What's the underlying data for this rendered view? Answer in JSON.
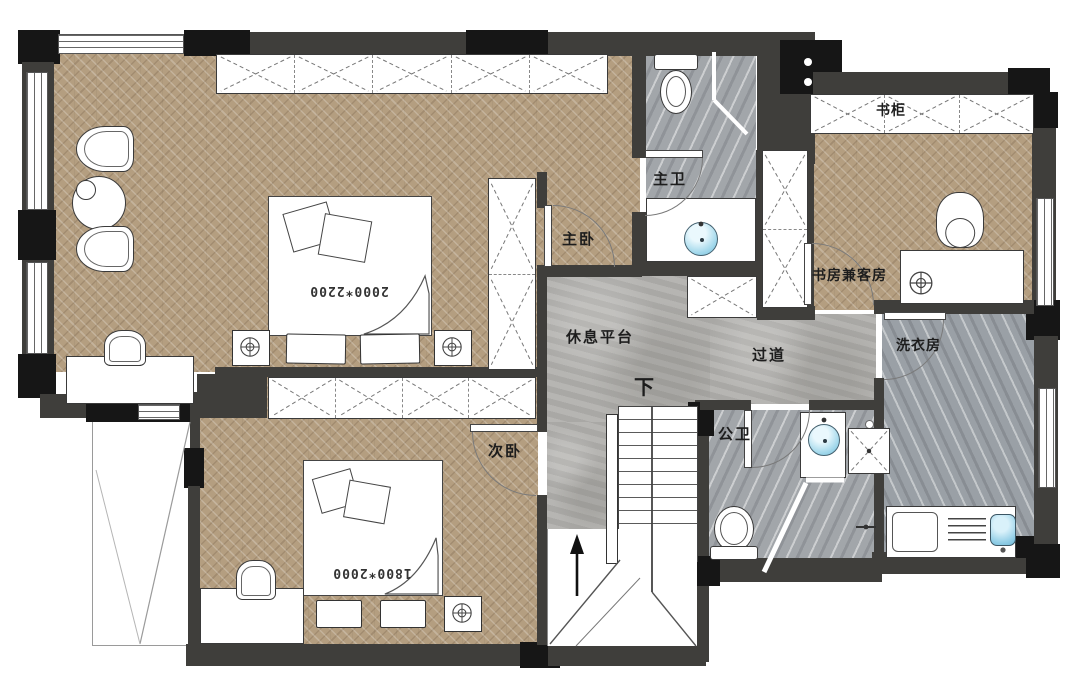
{
  "labels": {
    "master_bedroom": "主卧",
    "master_bath": "主卫",
    "bookcase": "书柜",
    "study_guest_room": "书房兼客房",
    "rest_platform": "休息平台",
    "corridor": "过道",
    "laundry_room": "洗衣房",
    "second_bedroom": "次卧",
    "public_bath": "公卫",
    "stairs_down": "下",
    "master_bed_size": "2000*2200",
    "second_bed_size": "1800*2000"
  },
  "colors": {
    "wood_floor": "#b49e80",
    "concrete_floor": "#b2b1ae",
    "marble_floor": "#a2a6aa",
    "wall": "#3f3e3b",
    "wall_black": "#161616",
    "water_blue": "#8fd0e8"
  }
}
